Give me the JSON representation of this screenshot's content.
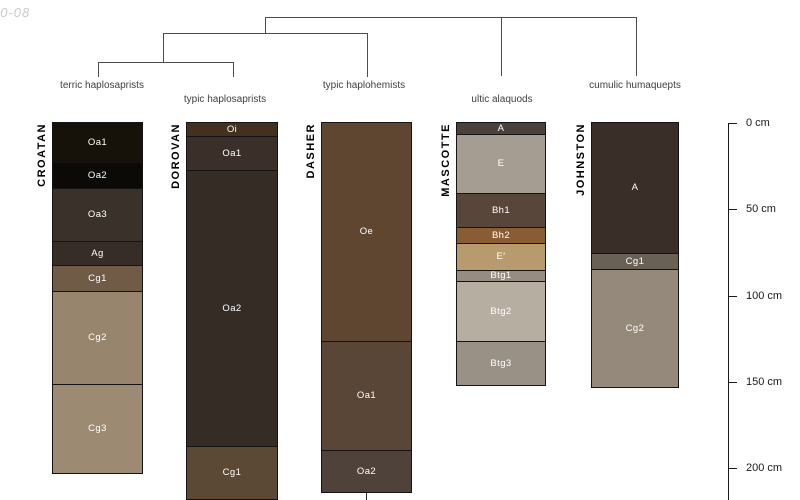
{
  "watermark": "10-08",
  "depth_axis": {
    "unit": "cm",
    "tick_labels": [
      "0 cm",
      "50 cm",
      "100 cm",
      "150 cm",
      "200 cm"
    ],
    "tick_values_cm": [
      0,
      50,
      100,
      150,
      200
    ]
  },
  "colors": {
    "background": "#ffffff",
    "dendrogram_line": "#4d4d4d",
    "horizon_border": "#141414",
    "horizon_label_text": "#ffffff",
    "taxon_label_text": "#404040",
    "axis_text": "#1a1a1a",
    "watermark_text": "#c9c9c9"
  },
  "chart_data": {
    "type": "bar",
    "subtype": "soil-profile-depth-columns-with-dendrogram",
    "title": "",
    "ylabel": "depth (cm)",
    "ylim_cm": [
      0,
      218
    ],
    "legend": "none",
    "grid": false,
    "dendrogram": {
      "taxa": [
        "terric haplosaprists",
        "typic haplosaprists",
        "typic haplohemists",
        "ultic alaquods",
        "cumulic humaquepts"
      ],
      "topology": "((terric haplosaprists, typic haplosaprists), typic haplohemists, ultic alaquods, cumulic humaquepts)"
    },
    "profiles": [
      {
        "name": "CROATAN",
        "classification": "terric haplosaprists",
        "horizons": [
          {
            "label": "Oa1",
            "top_cm": 0,
            "bottom_cm": 23,
            "color": "#171209"
          },
          {
            "label": "Oa2",
            "top_cm": 23,
            "bottom_cm": 38,
            "color": "#0c0a07"
          },
          {
            "label": "Oa3",
            "top_cm": 38,
            "bottom_cm": 69,
            "color": "#3a312a"
          },
          {
            "label": "Ag",
            "top_cm": 69,
            "bottom_cm": 83,
            "color": "#362c28"
          },
          {
            "label": "Cg1",
            "top_cm": 83,
            "bottom_cm": 98,
            "color": "#6f5b46"
          },
          {
            "label": "Cg2",
            "top_cm": 98,
            "bottom_cm": 152,
            "color": "#97856d"
          },
          {
            "label": "Cg3",
            "top_cm": 152,
            "bottom_cm": 203,
            "color": "#9c8a73"
          }
        ]
      },
      {
        "name": "DOROVAN",
        "classification": "typic haplosaprists",
        "horizons": [
          {
            "label": "Oi",
            "top_cm": 0,
            "bottom_cm": 8,
            "color": "#44301f"
          },
          {
            "label": "Oa1",
            "top_cm": 8,
            "bottom_cm": 28,
            "color": "#3a3029"
          },
          {
            "label": "Oa2",
            "top_cm": 28,
            "bottom_cm": 188,
            "color": "#352c25"
          },
          {
            "label": "Cg1",
            "top_cm": 188,
            "bottom_cm": 218,
            "color": "#5c4935"
          }
        ]
      },
      {
        "name": "DASHER",
        "classification": "typic haplohemists",
        "horizons": [
          {
            "label": "Oe",
            "top_cm": 0,
            "bottom_cm": 127,
            "color": "#5e4630"
          },
          {
            "label": "Oa1",
            "top_cm": 127,
            "bottom_cm": 190,
            "color": "#5a4637"
          },
          {
            "label": "Oa2",
            "top_cm": 190,
            "bottom_cm": 214,
            "color": "#4e423a"
          }
        ]
      },
      {
        "name": "MASCOTTE",
        "classification": "ultic alaquods",
        "horizons": [
          {
            "label": "A",
            "top_cm": 0,
            "bottom_cm": 7,
            "color": "#4a423a"
          },
          {
            "label": "E",
            "top_cm": 7,
            "bottom_cm": 41,
            "color": "#a59c92"
          },
          {
            "label": "Bh1",
            "top_cm": 41,
            "bottom_cm": 61,
            "color": "#59463a"
          },
          {
            "label": "Bh2",
            "top_cm": 61,
            "bottom_cm": 70,
            "color": "#8a5c33"
          },
          {
            "label": "E′",
            "top_cm": 70,
            "bottom_cm": 86,
            "color": "#b89a6f"
          },
          {
            "label": "Btg1",
            "top_cm": 86,
            "bottom_cm": 92,
            "color": "#968c81"
          },
          {
            "label": "Btg2",
            "top_cm": 92,
            "bottom_cm": 127,
            "color": "#b7aea2"
          },
          {
            "label": "Btg3",
            "top_cm": 127,
            "bottom_cm": 152,
            "color": "#9a9186"
          }
        ]
      },
      {
        "name": "JOHNSTON",
        "classification": "cumulic humaquepts",
        "horizons": [
          {
            "label": "A",
            "top_cm": 0,
            "bottom_cm": 76,
            "color": "#3a2f28"
          },
          {
            "label": "Cg1",
            "top_cm": 76,
            "bottom_cm": 85,
            "color": "#6a6156"
          },
          {
            "label": "Cg2",
            "top_cm": 85,
            "bottom_cm": 153,
            "color": "#94897a"
          }
        ]
      }
    ]
  }
}
